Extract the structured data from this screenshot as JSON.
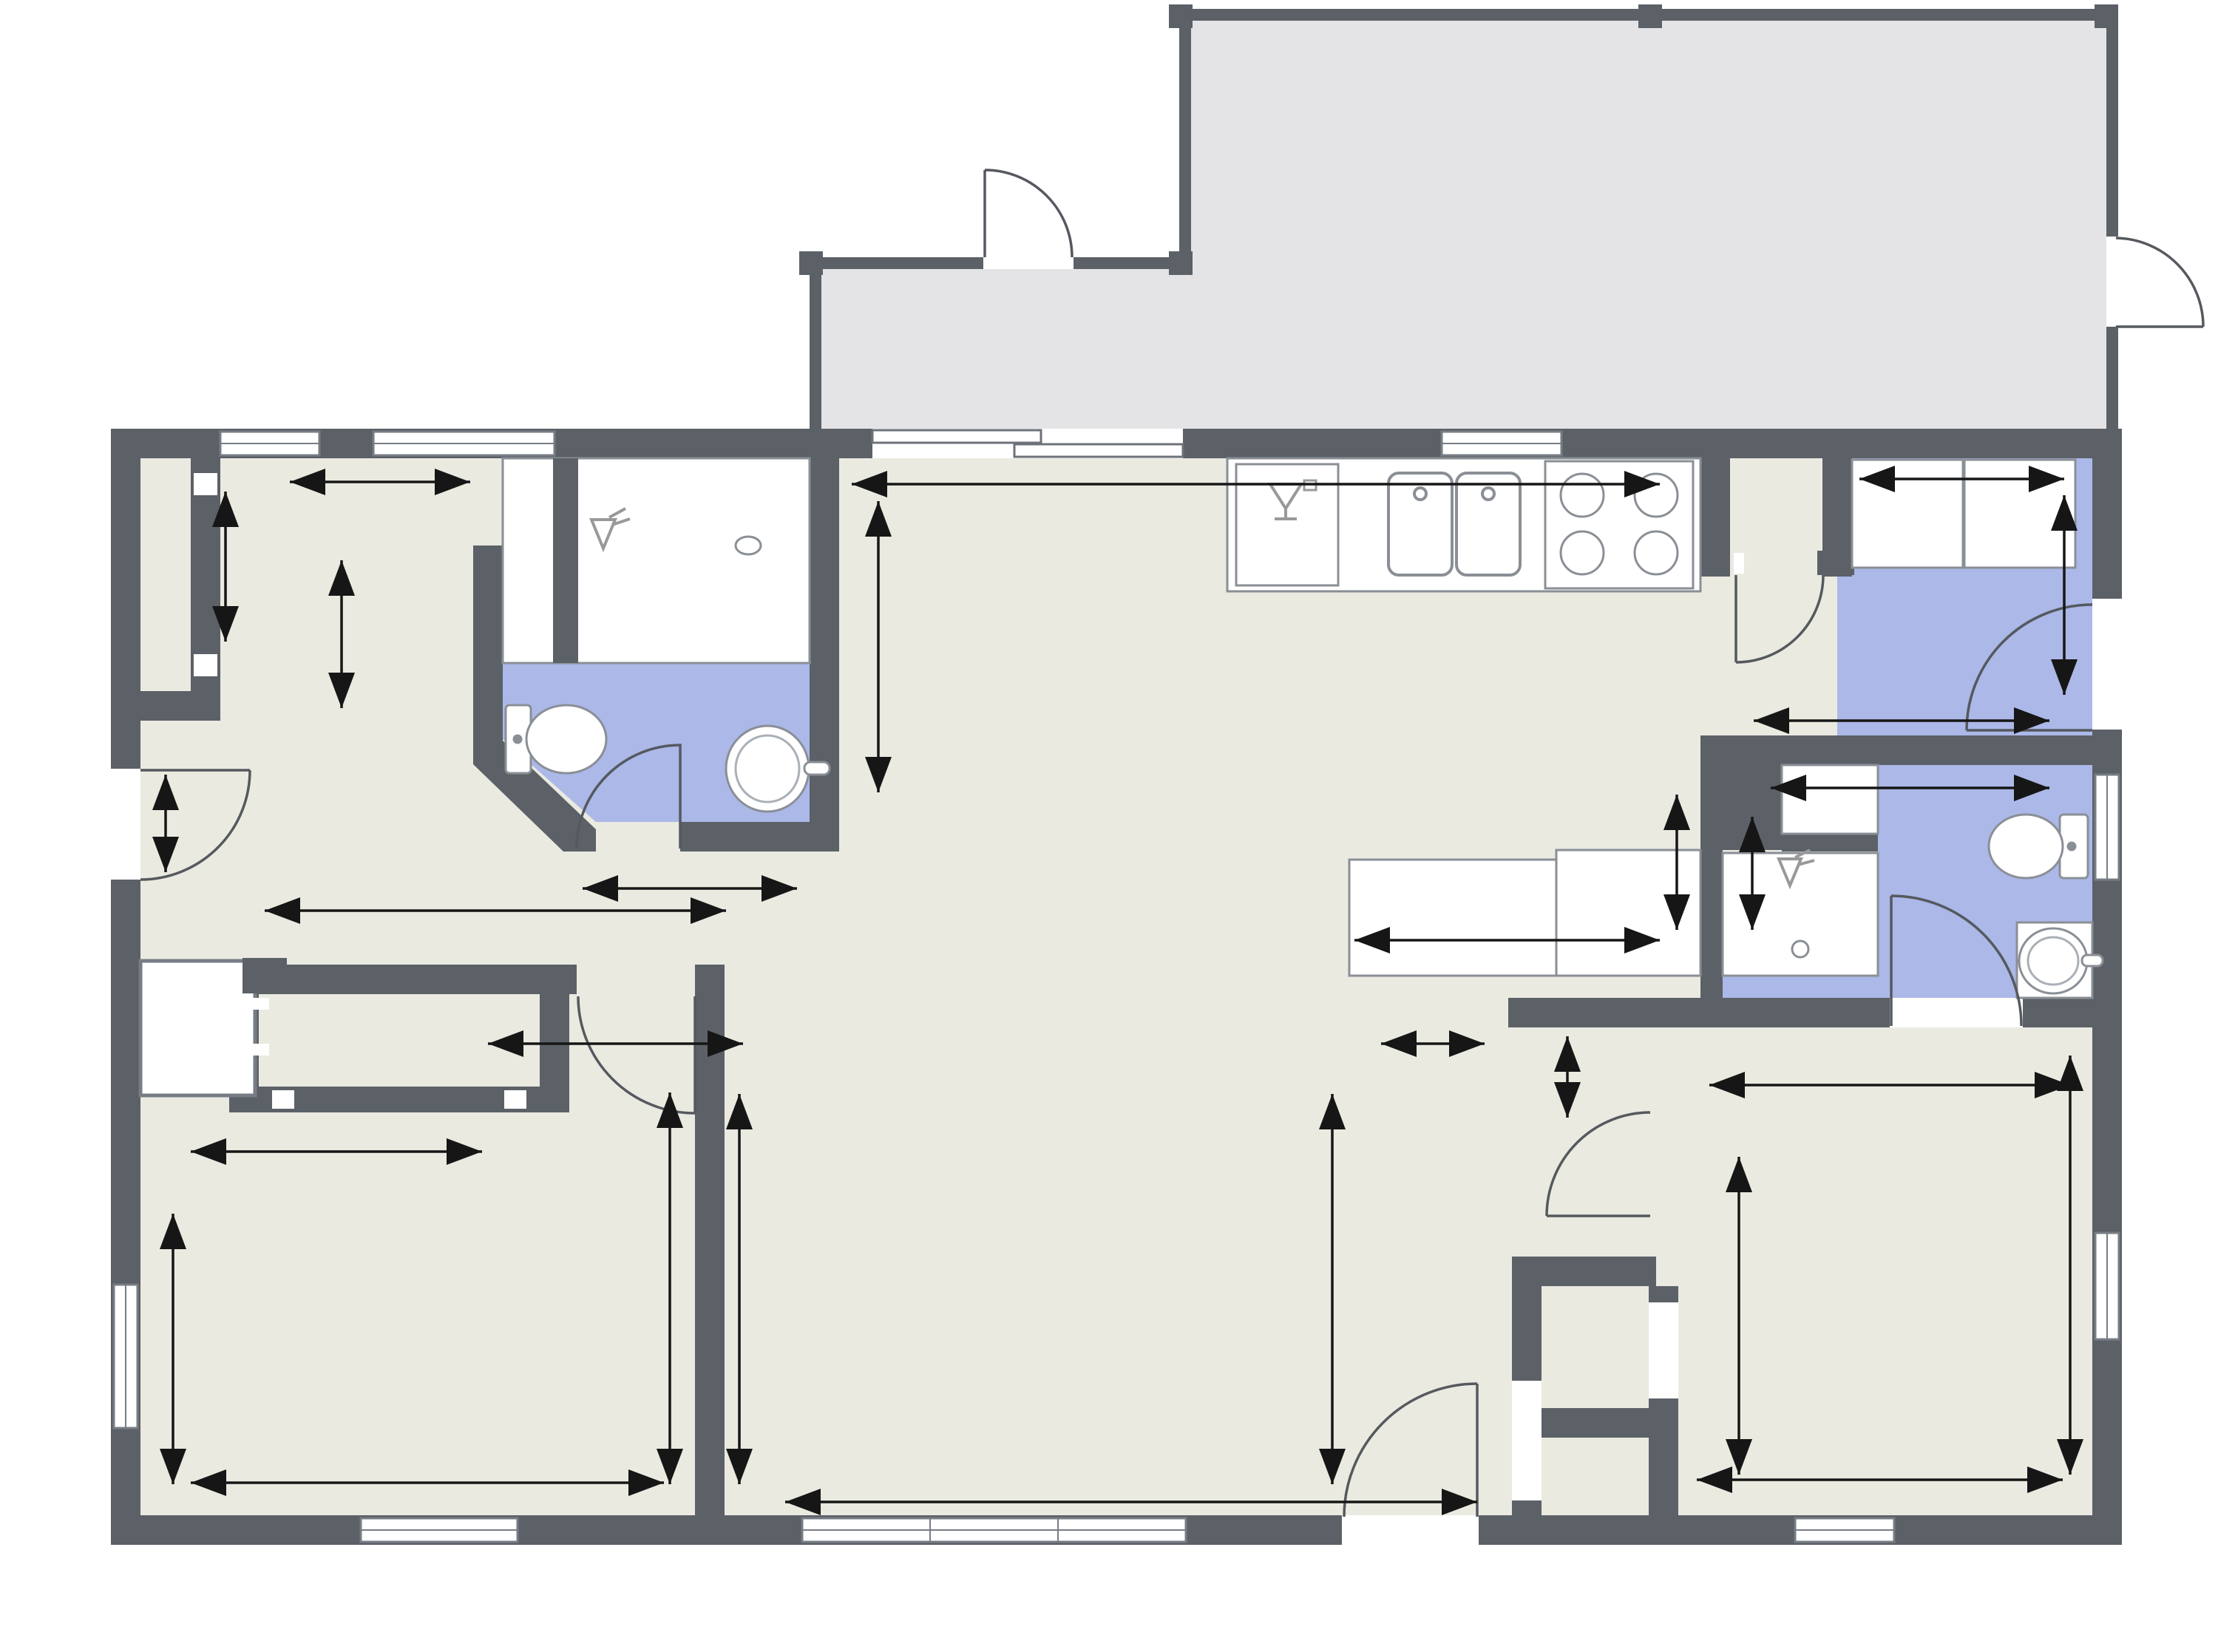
{
  "watermark": "©2026 Hive MLS",
  "colors": {
    "wall": "#5c6168",
    "floor": "#eaeae1",
    "porch_floor": "#e4e4e6",
    "wet_floor": "#abb8e8",
    "fixture_line": "#888888",
    "dimension_line": "#161616"
  },
  "labels": [
    {
      "id": "screened-porch",
      "text": "Screened Porch"
    },
    {
      "id": "closet-hall",
      "text": "Closet"
    },
    {
      "id": "bathroom-1",
      "text": "Bathroom"
    },
    {
      "id": "dining-room",
      "text": "Dining Room"
    },
    {
      "id": "kitchen",
      "text": "Kitchen"
    },
    {
      "id": "pantry",
      "text": "P"
    },
    {
      "id": "washer",
      "text": "W"
    },
    {
      "id": "dryer",
      "text": "D"
    },
    {
      "id": "laundry",
      "text": "Laundry"
    },
    {
      "id": "refrigerator",
      "text": "Ref"
    },
    {
      "id": "bathroom-2",
      "text": "Bathroom"
    },
    {
      "id": "closet-bedroom1",
      "text": "Closet"
    },
    {
      "id": "bedroom-1",
      "text": "Bedroom"
    },
    {
      "id": "living-room",
      "text": "Living Room"
    },
    {
      "id": "foyer",
      "text": "Foyer"
    },
    {
      "id": "closet-bedroom2",
      "text": "Closet"
    },
    {
      "id": "closet-foyer",
      "text": "Closet"
    },
    {
      "id": "bedroom-2",
      "text": "Bedroom"
    }
  ],
  "dims": [
    {
      "id": "hall-width",
      "text": "7' 0\""
    },
    {
      "id": "hall-depth",
      "text": "5' 1\""
    },
    {
      "id": "dressing-depth",
      "text": "5' 2\""
    },
    {
      "id": "entry-width",
      "text": "3' 11\""
    },
    {
      "id": "bath1-width",
      "text": "6' 7\""
    },
    {
      "id": "hall-length",
      "text": "12' 4\""
    },
    {
      "id": "dining-depth",
      "text": "7' 10\""
    },
    {
      "id": "kitchen-length",
      "text": "19' 6\""
    },
    {
      "id": "washer-dryer-width",
      "text": "5' 3\""
    },
    {
      "id": "laundry-depth",
      "text": "6' 5\""
    },
    {
      "id": "laundry-width",
      "text": "8' 2\""
    },
    {
      "id": "counter-width",
      "text": "8' 4\""
    },
    {
      "id": "fridge-nook-depth",
      "text": "4' 11\""
    },
    {
      "id": "shower-depth",
      "text": "4' 7\""
    },
    {
      "id": "bath2-width",
      "text": "7' 10\""
    },
    {
      "id": "hall2-width",
      "text": "4' 5\""
    },
    {
      "id": "hall2-nook",
      "text": "3' 5\""
    },
    {
      "id": "bed2-top-width",
      "text": "11' 10\""
    },
    {
      "id": "bed1-door-width",
      "text": "5' 9\""
    },
    {
      "id": "closet1b-width",
      "text": "6' 2\""
    },
    {
      "id": "bed1-depth",
      "text": "9' 4\""
    },
    {
      "id": "bed1-height",
      "text": "11' 6\""
    },
    {
      "id": "bed1-width",
      "text": "12' 0\""
    },
    {
      "id": "living-left-height",
      "text": "11' 6\""
    },
    {
      "id": "living-right-height",
      "text": "11' 6\""
    },
    {
      "id": "living-width",
      "text": "17' 11\""
    },
    {
      "id": "bed2-left-height",
      "text": "8' 2\""
    },
    {
      "id": "bed2-right-height",
      "text": "11' 6\""
    },
    {
      "id": "bed2-width",
      "text": "9' 3\""
    }
  ]
}
